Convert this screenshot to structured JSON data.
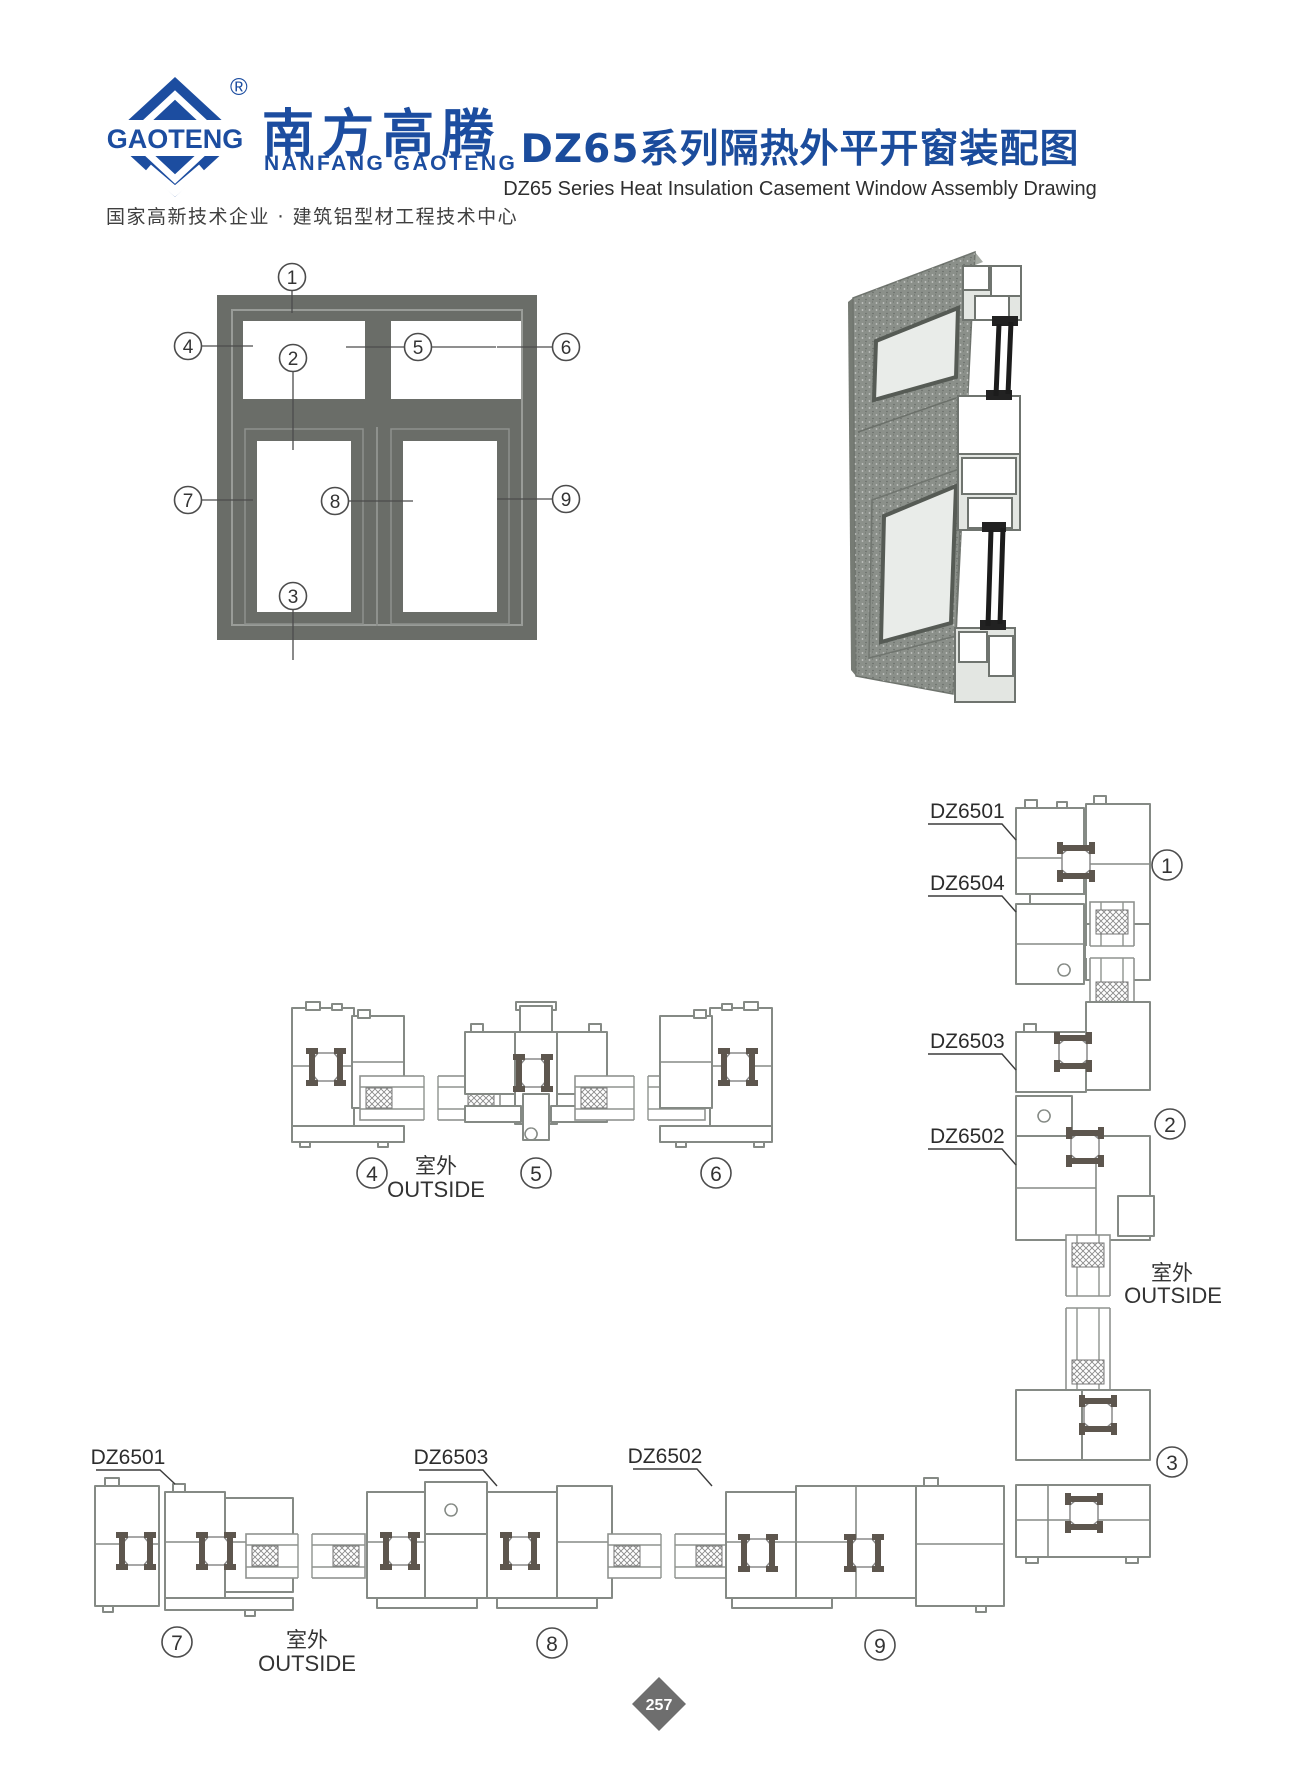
{
  "header": {
    "logo_mark": "GAOTENG",
    "logo_registered": "®",
    "brand_cn": "南方高腾",
    "brand_en": "NANFANG GAOTENG",
    "tagline": "国家高新技术企业 · 建筑铝型材工程技术中心",
    "title_cn": "DZ65系列隔热外平开窗装配图",
    "title_en": "DZ65 Series Heat Insulation Casement Window Assembly Drawing"
  },
  "callouts": {
    "c1": "1",
    "c2": "2",
    "c3": "3",
    "c4": "4",
    "c5": "5",
    "c6": "6",
    "c7": "7",
    "c8": "8",
    "c9": "9"
  },
  "labels": {
    "right_col": {
      "l1": "DZ6501",
      "l2": "DZ6504",
      "l3": "DZ6503",
      "l4": "DZ6502"
    },
    "bottom": {
      "l1": "DZ6501",
      "l2": "DZ6503",
      "l3": "DZ6502"
    }
  },
  "outside": {
    "cn": "室外",
    "en": "OUTSIDE"
  },
  "footer": {
    "page_number": "257"
  }
}
